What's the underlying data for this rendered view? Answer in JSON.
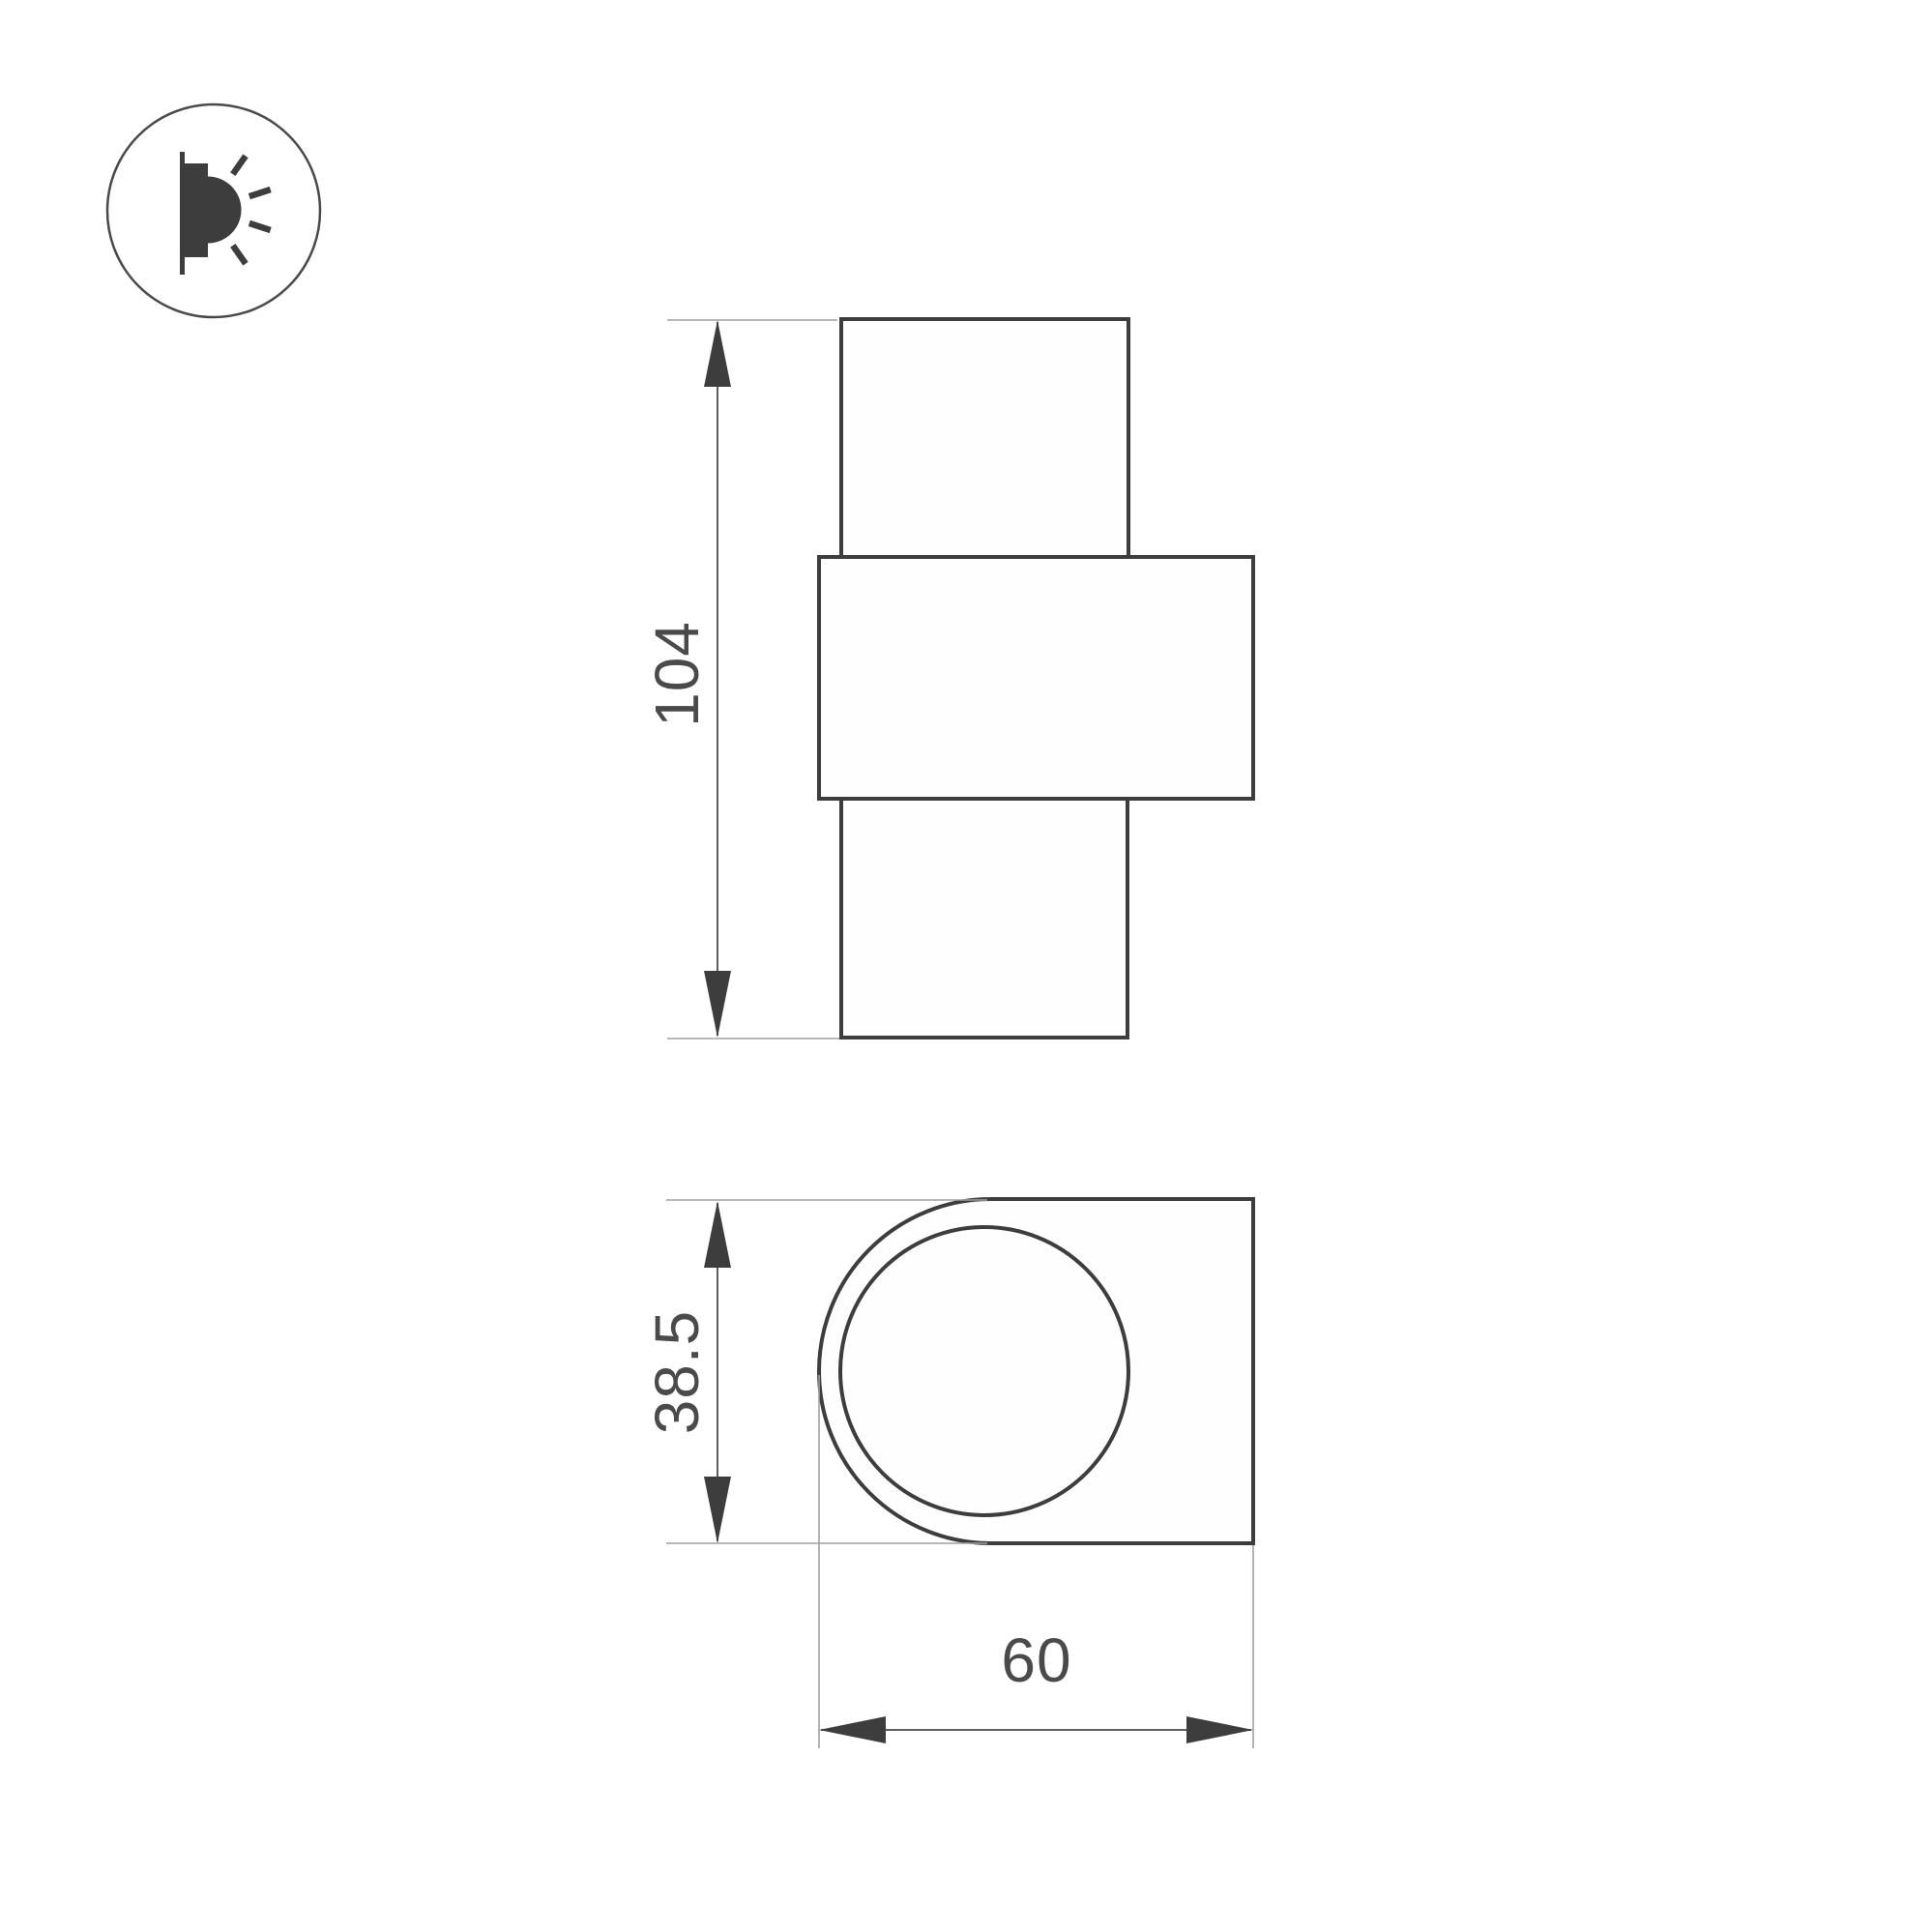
{
  "icon": {
    "type": "wall-light-emitting-icon"
  },
  "drawing": {
    "front_view": {
      "height_mm": "104"
    },
    "profile_view": {
      "height_mm": "38.5",
      "width_mm": "60"
    }
  },
  "colors": {
    "outline": "#3d3d3d",
    "dimension_line": "#5f5f5f",
    "extension_line": "#a0a0a0",
    "label_text": "#4a4a4a",
    "background": "#ffffff"
  }
}
